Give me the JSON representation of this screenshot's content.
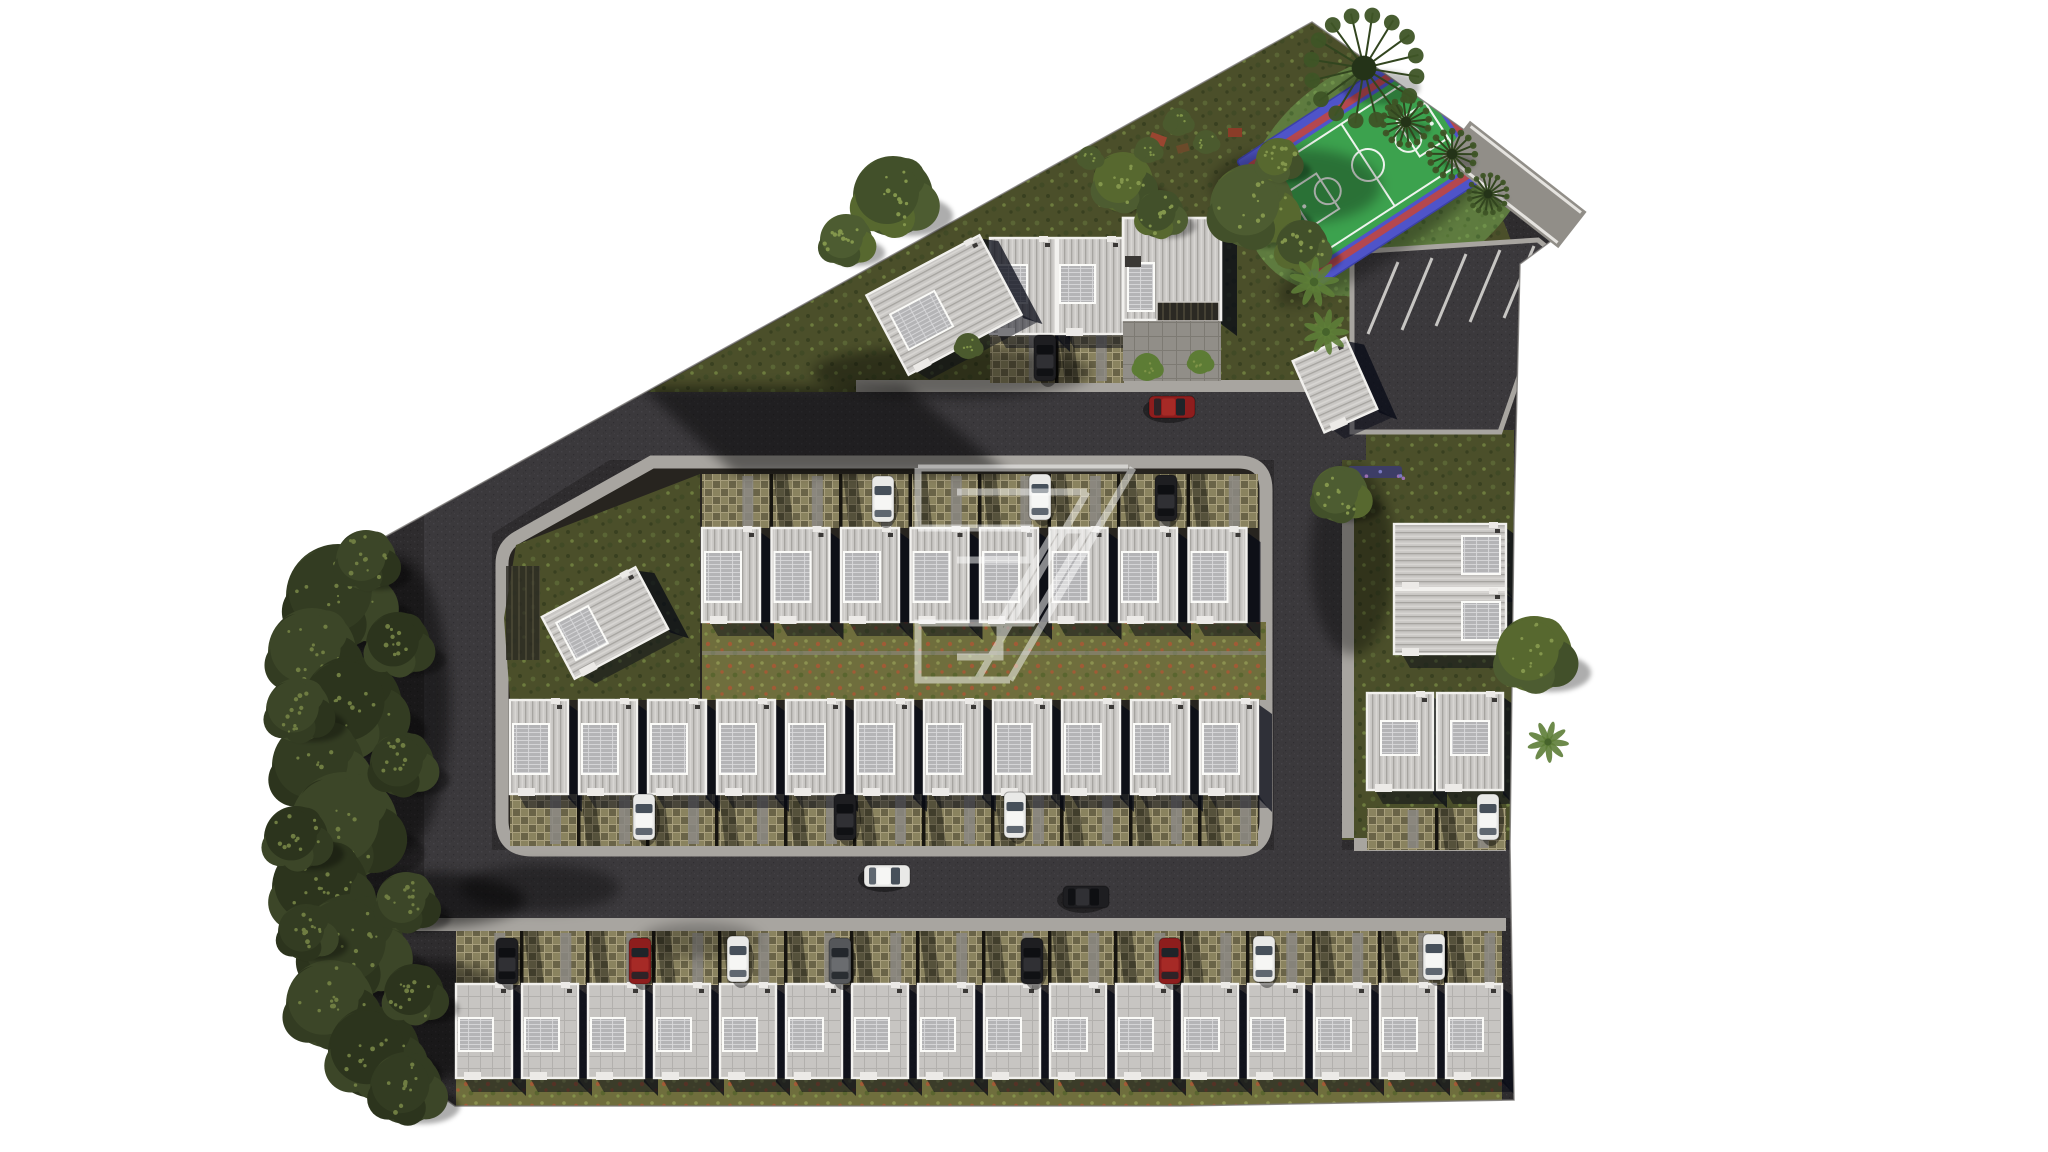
{
  "meta": {
    "description": "Aerial top-down 3D architectural masterplan rendering of a gated townhouse condominium with a watermark logo",
    "canvas": {
      "width": 2048,
      "height": 1152
    },
    "background": "#ffffff"
  },
  "palette": {
    "asphalt": "#2e2c2e",
    "road": "#3b393c",
    "sidewalk": "#a8a5a0",
    "curb_edge": "#7a7876",
    "block_ground": "#27241f",
    "roof_light": "#c9c7c4",
    "roof_eave": "#f2f1ee",
    "solar_panel": "#b7b5b3",
    "paver_tan": "#8a835f",
    "grass_olive": "#6f6e3d",
    "grass_dark": "#4b4f2a",
    "grass_bright": "#5f7d40",
    "shadow_navy": "rgba(7,10,22,0.75)",
    "court_blue": "#4f54c9",
    "court_red": "#b4474f",
    "court_green": "#3ca24e",
    "court_lines": "#eef4ee",
    "logo_white": "rgba(255,255,255,0.52)",
    "cars": {
      "white": {
        "body": "#e9e9e7",
        "roof": "#f6f6f4",
        "glass": "#47505a"
      },
      "red": {
        "body": "#8e1d1d",
        "roof": "#a62a26",
        "glass": "#1f2429"
      },
      "black": {
        "body": "#1e1e21",
        "roof": "#303034",
        "glass": "#0e0f12"
      },
      "gray": {
        "body": "#55575a",
        "roof": "#6a6c6f",
        "glass": "#23272c"
      }
    }
  },
  "logo": {
    "glyph": "7",
    "style": "outlined watermark",
    "x": 912,
    "y": 462,
    "opacity": 0.5,
    "stroke_width": 7,
    "paths": [
      "M6,6 H216",
      "M6,6 V66",
      "M6,66 H118 V98 H45",
      "M45,30 H175",
      "M221,6 L98,218",
      "M175,30 L65,218",
      "M98,218 H6 V161 H88 V195 H45",
      "M88,161 L143,68 L175,68 L120,161 Z"
    ]
  },
  "scene": {
    "boundary": [
      [
        1312,
        22
      ],
      [
        1470,
        134
      ],
      [
        1574,
        224
      ],
      [
        1520,
        264
      ],
      [
        1514,
        520
      ],
      [
        1510,
        845
      ],
      [
        1514,
        1100
      ],
      [
        1180,
        1106
      ],
      [
        455,
        1106
      ],
      [
        372,
        1048
      ],
      [
        350,
        998
      ],
      [
        334,
        942
      ],
      [
        350,
        872
      ],
      [
        318,
        806
      ],
      [
        330,
        742
      ],
      [
        304,
        664
      ],
      [
        320,
        600
      ],
      [
        356,
        552
      ],
      [
        372,
        544
      ]
    ],
    "roads": {
      "loop": [
        [
          1366,
          426
        ],
        [
          600,
          426
        ],
        [
          458,
          515
        ],
        [
          458,
          884
        ],
        [
          1512,
          884
        ]
      ],
      "right": [
        [
          1308,
          426
        ],
        [
          1308,
          884
        ]
      ],
      "width": 68
    },
    "sidewalks": {
      "block_ring": "M652,462 H1238 Q1266,462 1266,490 V820 Q1266,850 1238,850 H532 Q502,850 502,820 V564 Q502,546 518,537 Z",
      "rects": [
        [
          336,
          918,
          1170,
          13
        ],
        [
          1354,
          838,
          152,
          13
        ],
        [
          856,
          380,
          496,
          12
        ],
        [
          1342,
          470,
          12,
          368
        ]
      ]
    },
    "grass": {
      "top_cluster": [
        [
          648,
          392
        ],
        [
          1352,
          392
        ],
        [
          1352,
          300
        ],
        [
          1520,
          264
        ],
        [
          1470,
          134
        ],
        [
          1312,
          22
        ]
      ],
      "right_column": [
        1342,
        430,
        172,
        410
      ],
      "wedge": [
        [
          516,
          545
        ],
        [
          700,
          474
        ],
        [
          700,
          700
        ],
        [
          510,
          700
        ],
        [
          504,
          618
        ]
      ],
      "strips": [
        [
          702,
          622,
          564,
          78
        ],
        [
          456,
          1078,
          1046,
          28
        ]
      ],
      "court_lawn": {
        "cx": 1390,
        "cy": 172,
        "rx": 155,
        "ry": 112,
        "rot": -30
      },
      "walkway": [
        702,
        651,
        564,
        4
      ],
      "utility_pad": [
        506,
        566,
        34,
        94
      ]
    },
    "court": {
      "cx": 1368,
      "cy": 165,
      "rot": -33,
      "apron_w": 216,
      "apron_h": 150
    },
    "parking": {
      "outline": [
        [
          1352,
          252
        ],
        [
          1538,
          240
        ],
        [
          1560,
          258
        ],
        [
          1500,
          432
        ],
        [
          1352,
          432
        ]
      ],
      "stripes": [
        [
          1398,
          262,
          1368,
          334
        ],
        [
          1432,
          258,
          1402,
          330
        ],
        [
          1466,
          254,
          1436,
          326
        ],
        [
          1500,
          250,
          1470,
          322
        ],
        [
          1534,
          246,
          1504,
          318
        ]
      ]
    },
    "entrance": {
      "x": 1442,
      "y": 158,
      "w": 148,
      "h": 46,
      "rot": 38,
      "cx": 1510,
      "cy": 180
    },
    "driveways": [
      {
        "x": 702,
        "y": 474,
        "w": 556,
        "h": 54,
        "count": 8,
        "pitch": 69.5
      },
      {
        "x": 510,
        "y": 794,
        "w": 748,
        "h": 52,
        "count": 11,
        "pitch": 69
      },
      {
        "x": 456,
        "y": 931,
        "w": 1046,
        "h": 54,
        "count": 16,
        "pitch": 66
      },
      {
        "x": 990,
        "y": 333,
        "w": 134,
        "h": 50,
        "count": 2,
        "pitch": 67
      },
      {
        "x": 1367,
        "y": 808,
        "w": 139,
        "h": 42,
        "count": 2,
        "pitch": 70
      }
    ],
    "house_rows": [
      {
        "x": 702,
        "y": 528,
        "w": 58,
        "h": 94,
        "count": 8,
        "pitch": 69.5,
        "roof": "v",
        "solar": [
          3,
          24,
          36,
          50
        ]
      },
      {
        "x": 510,
        "y": 700,
        "w": 58,
        "h": 94,
        "count": 11,
        "pitch": 69,
        "roof": "v",
        "solar": [
          3,
          24,
          36,
          50
        ]
      },
      {
        "x": 456,
        "y": 984,
        "w": 56,
        "h": 94,
        "count": 16,
        "pitch": 66,
        "roof": "grid",
        "solar": [
          3,
          34,
          34,
          33
        ]
      },
      {
        "x": 990,
        "y": 238,
        "w": 66,
        "h": 96,
        "count": 2,
        "pitch": 68,
        "roof": "v",
        "solar": [
          2,
          27,
          35,
          38
        ]
      },
      {
        "x": 1367,
        "y": 693,
        "w": 66,
        "h": 97,
        "count": 2,
        "pitch": 70,
        "roof": "v",
        "solar": [
          14,
          28,
          38,
          34
        ]
      },
      {
        "x": 1394,
        "y": 524,
        "w": 112,
        "h": 64,
        "count": 2,
        "pitch": 66,
        "roof": "h",
        "solar": [
          68,
          12,
          38,
          38
        ],
        "dir": "down"
      }
    ],
    "tilted_buildings": [
      {
        "x": 880,
        "y": 260,
        "w": 128,
        "h": 90,
        "rot": -28,
        "roof": "h",
        "solar": [
          12,
          28,
          50,
          40
        ],
        "name": "tilted-house"
      },
      {
        "x": 552,
        "y": 588,
        "w": 106,
        "h": 70,
        "rot": -28,
        "roof": "h",
        "solar": [
          10,
          12,
          36,
          42
        ],
        "name": "corner-house"
      },
      {
        "x": 1306,
        "y": 346,
        "w": 58,
        "h": 78,
        "rot": -24,
        "roof": "h",
        "solar": null,
        "name": "carport"
      }
    ],
    "clubhouse": {
      "base": [
        1123,
        218,
        98,
        102
      ],
      "stair": [
        1128,
        263,
        26,
        48
      ],
      "panel": [
        1125,
        256,
        16,
        11
      ],
      "pergola": [
        1157,
        302,
        62,
        19
      ],
      "patio": [
        1123,
        321,
        98,
        60
      ]
    },
    "cars": [
      [
        1045,
        358,
        0,
        "black"
      ],
      [
        1172,
        407,
        90,
        "red"
      ],
      [
        883,
        499,
        0,
        "white"
      ],
      [
        1040,
        497,
        0,
        "white"
      ],
      [
        1166,
        498,
        0,
        "black"
      ],
      [
        644,
        817,
        0,
        "white"
      ],
      [
        845,
        817,
        0,
        "black"
      ],
      [
        1015,
        815,
        0,
        "white"
      ],
      [
        887,
        876,
        90,
        "white"
      ],
      [
        1086,
        897,
        90,
        "black"
      ],
      [
        1488,
        817,
        0,
        "white"
      ],
      [
        507,
        961,
        0,
        "black"
      ],
      [
        640,
        961,
        0,
        "red"
      ],
      [
        738,
        959,
        0,
        "white"
      ],
      [
        840,
        961,
        0,
        "gray"
      ],
      [
        1032,
        961,
        0,
        "black"
      ],
      [
        1170,
        961,
        0,
        "red"
      ],
      [
        1264,
        959,
        0,
        "white"
      ],
      [
        1434,
        957,
        0,
        "white"
      ]
    ],
    "trees": [
      [
        338,
        596,
        52,
        "dark"
      ],
      [
        312,
        652,
        44,
        "dark"
      ],
      [
        352,
        706,
        50,
        "dark"
      ],
      [
        318,
        766,
        46,
        "dark"
      ],
      [
        344,
        826,
        54,
        "dark"
      ],
      [
        320,
        888,
        48,
        "dark"
      ],
      [
        352,
        946,
        52,
        "dark"
      ],
      [
        330,
        1004,
        44,
        "dark"
      ],
      [
        374,
        1052,
        46,
        "dark"
      ],
      [
        406,
        1088,
        36,
        "dark"
      ],
      [
        298,
        710,
        32,
        "dark"
      ],
      [
        296,
        838,
        32,
        "dark"
      ],
      [
        306,
        932,
        28,
        "dark"
      ],
      [
        366,
        560,
        30,
        "dark"
      ],
      [
        398,
        644,
        32,
        "dark"
      ],
      [
        402,
        764,
        32,
        "dark"
      ],
      [
        406,
        902,
        30,
        "dark"
      ],
      [
        414,
        994,
        30,
        "dark"
      ],
      [
        893,
        196,
        40,
        "green"
      ],
      [
        846,
        240,
        26,
        "green"
      ],
      [
        1123,
        182,
        30,
        "green"
      ],
      [
        1160,
        214,
        24,
        "green"
      ],
      [
        1252,
        206,
        42,
        "green"
      ],
      [
        1278,
        160,
        22,
        "green"
      ],
      [
        1302,
        246,
        26,
        "green"
      ],
      [
        1340,
        494,
        28,
        "green"
      ],
      [
        1534,
        654,
        38,
        "green"
      ],
      [
        1364,
        68,
        56,
        "araucaria"
      ],
      [
        1406,
        122,
        24,
        "araucaria"
      ],
      [
        1452,
        154,
        24,
        "araucaria"
      ],
      [
        1488,
        194,
        20,
        "araucaria"
      ],
      [
        1314,
        282,
        24,
        "palm"
      ],
      [
        1326,
        332,
        22,
        "palm"
      ],
      [
        1548,
        742,
        20,
        "palm"
      ],
      [
        1178,
        122,
        14,
        "bush"
      ],
      [
        1206,
        142,
        12,
        "bush"
      ],
      [
        1148,
        150,
        13,
        "bush"
      ],
      [
        968,
        346,
        13,
        "bush"
      ],
      [
        1090,
        158,
        12,
        "bush"
      ],
      [
        1147,
        367,
        14,
        "bushBright"
      ],
      [
        1200,
        362,
        12,
        "bushBright"
      ]
    ],
    "shadows": [
      {
        "type": "poly",
        "pts": [
          [
            640,
            386
          ],
          [
            905,
            386
          ],
          [
            1010,
            474
          ],
          [
            735,
            474
          ]
        ],
        "o": 0.45
      },
      {
        "type": "ellipse",
        "cx": 420,
        "cy": 900,
        "rx": 105,
        "ry": 28,
        "o": 0.5
      },
      {
        "type": "ellipse",
        "cx": 395,
        "cy": 705,
        "rx": 55,
        "ry": 150,
        "o": 0.45
      },
      {
        "type": "ellipse",
        "cx": 540,
        "cy": 888,
        "rx": 80,
        "ry": 24,
        "o": 0.35
      },
      {
        "type": "ellipse",
        "cx": 952,
        "cy": 372,
        "rx": 140,
        "ry": 26,
        "o": 0.4
      },
      {
        "type": "ellipse",
        "cx": 1352,
        "cy": 560,
        "rx": 42,
        "ry": 95,
        "o": 0.35
      },
      {
        "type": "ellipse",
        "cx": 1296,
        "cy": 186,
        "rx": 85,
        "ry": 38,
        "o": 0.3
      },
      {
        "type": "ellipse",
        "cx": 430,
        "cy": 1020,
        "rx": 90,
        "ry": 60,
        "o": 0.45
      },
      {
        "type": "ellipse",
        "cx": 700,
        "cy": 940,
        "rx": 60,
        "ry": 18,
        "o": 0.25
      }
    ],
    "flowerbeds": [
      [
        1348,
        466,
        54,
        12
      ],
      [
        1256,
        228,
        30,
        12
      ]
    ],
    "playground": [
      [
        1152,
        132,
        16,
        10,
        20
      ],
      [
        1176,
        146,
        12,
        8,
        -15
      ],
      [
        1228,
        128,
        14,
        9,
        0
      ]
    ]
  }
}
